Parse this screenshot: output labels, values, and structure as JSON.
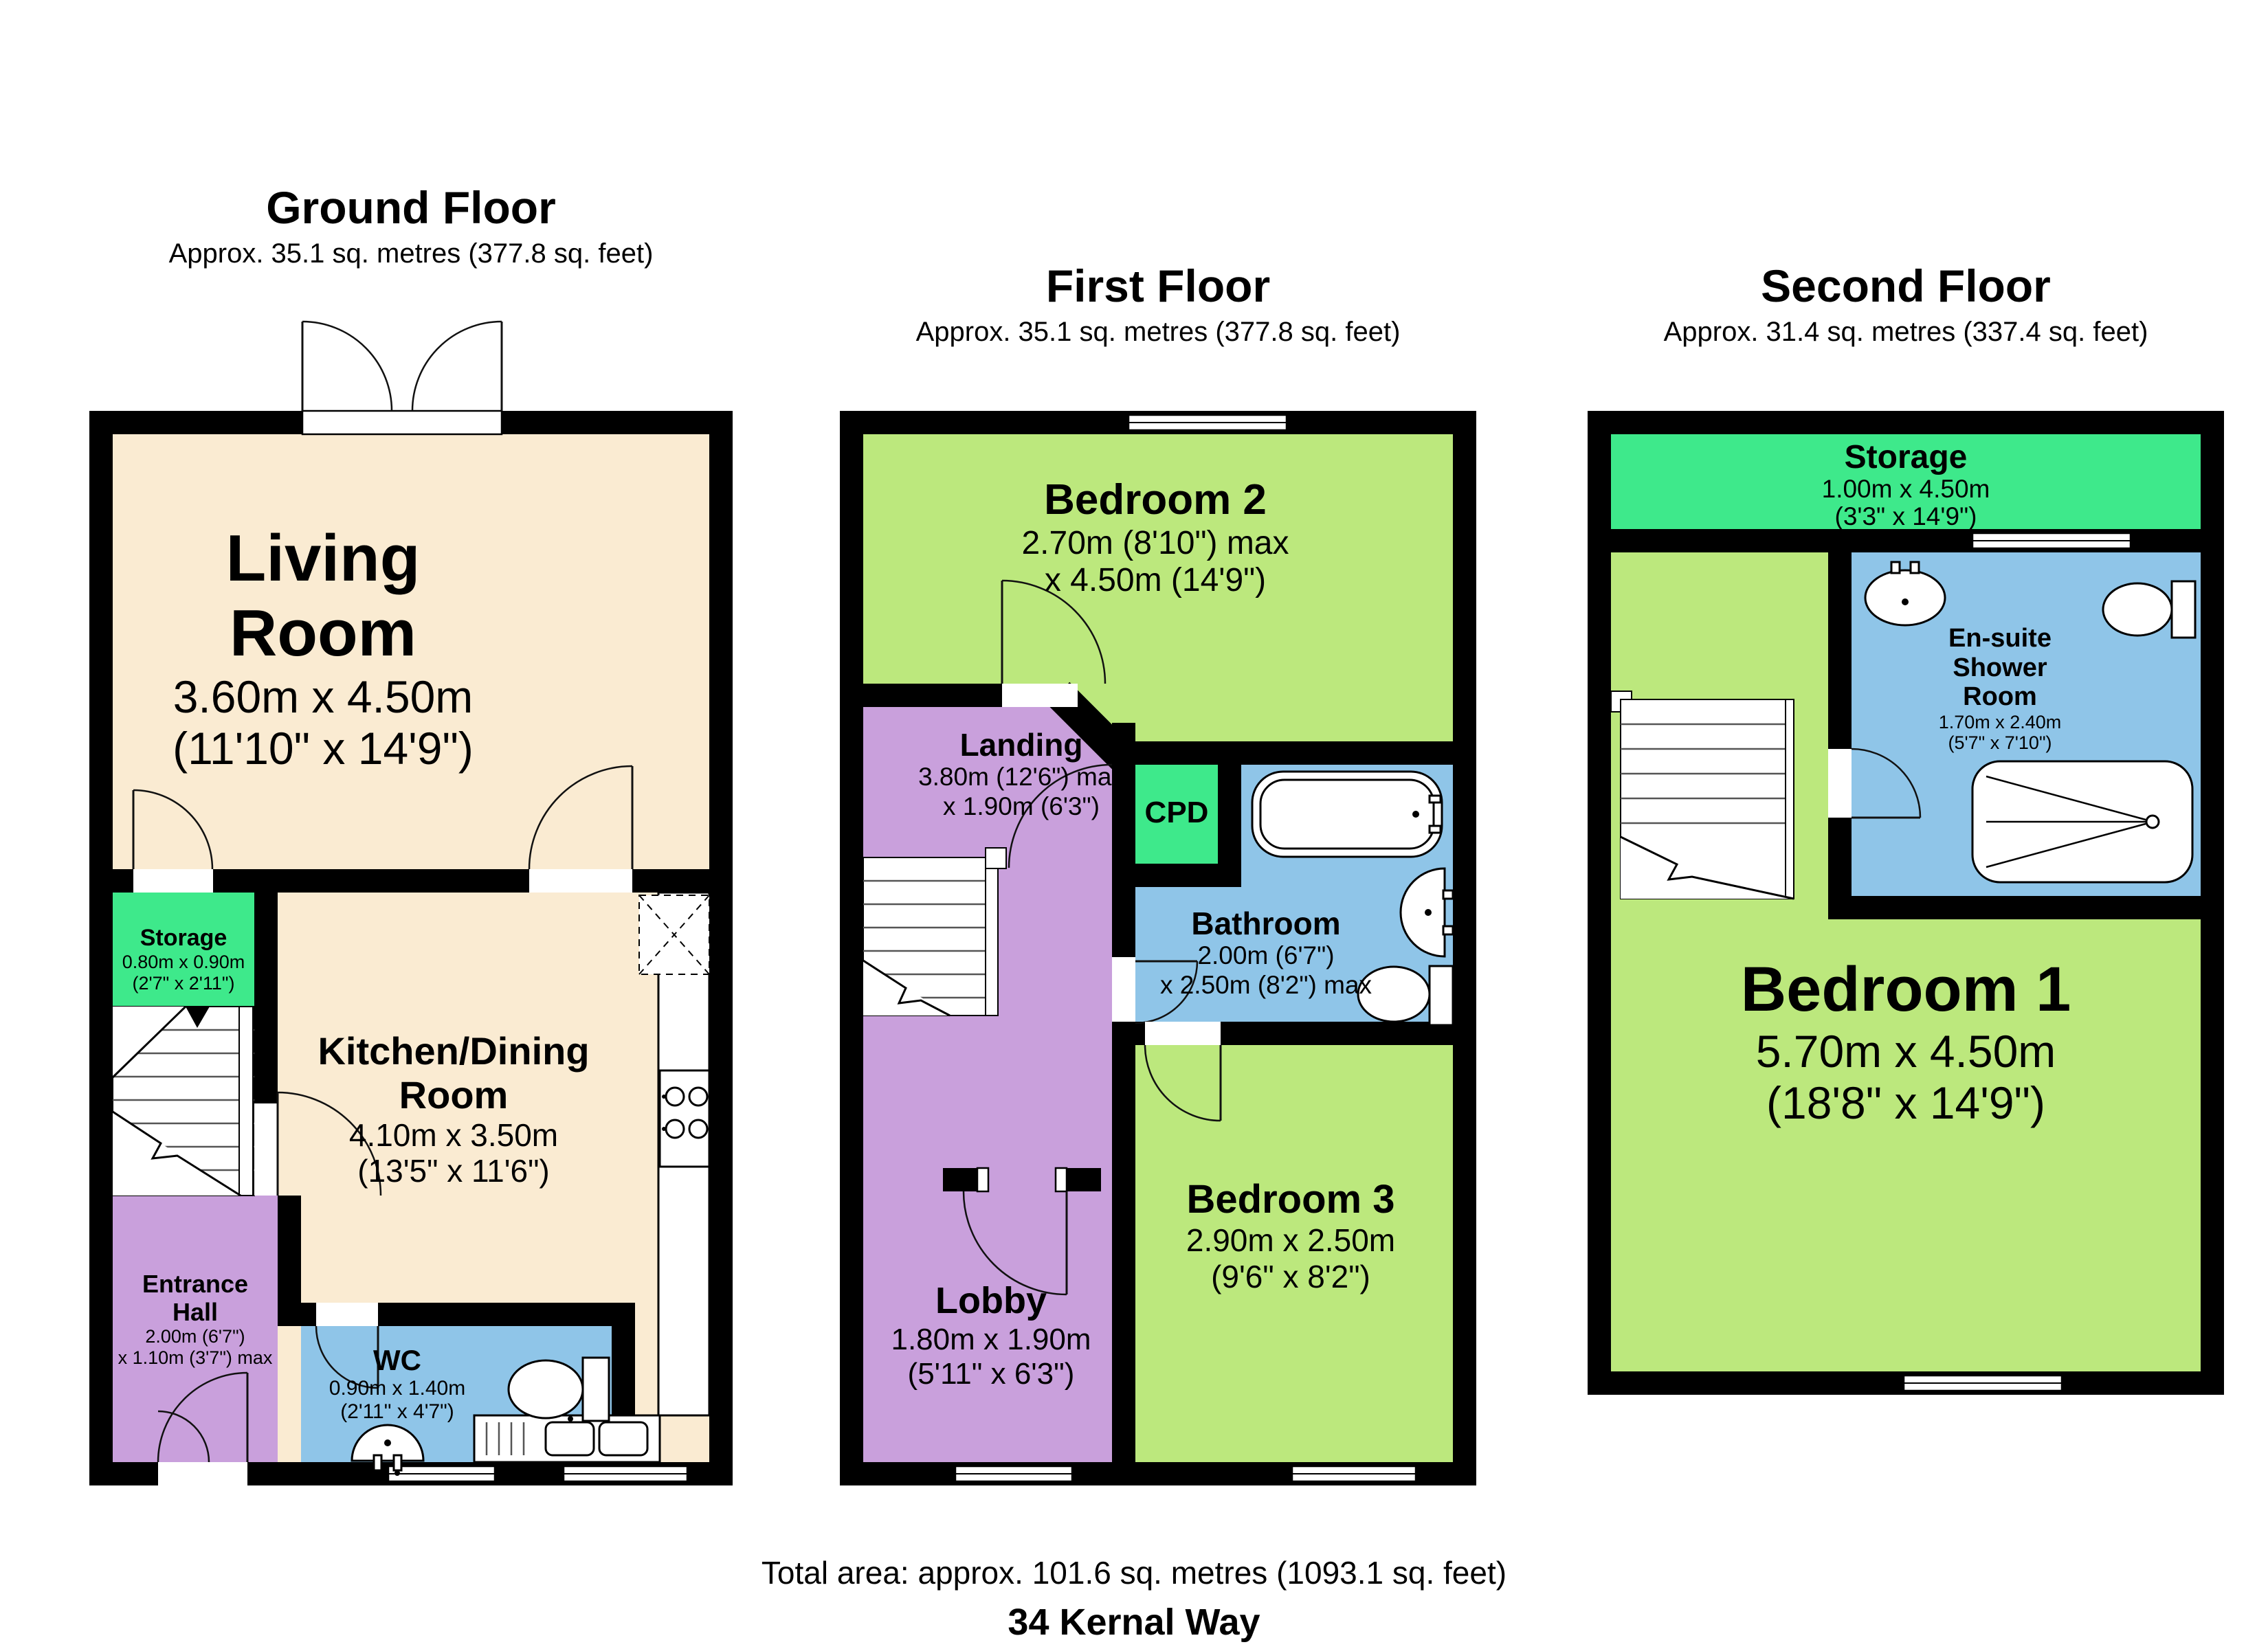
{
  "document": {
    "total_area": "Total area: approx. 101.6 sq. metres (1093.1 sq. feet)",
    "address": "34 Kernal Way"
  },
  "colors": {
    "cream": "#FAEBD2",
    "room_green": "#BCE87D",
    "bright_green": "#3EE98B",
    "purple": "#C9A0DC",
    "blue": "#8FC5E8",
    "wall": "#000000"
  },
  "floors": [
    {
      "name": "Ground Floor",
      "area": "Approx. 35.1 sq. metres (377.8 sq. feet)",
      "rooms": [
        {
          "name": "Living Room",
          "dim1": "3.60m x 4.50m",
          "dim2": "(11'10\" x 14'9\")"
        },
        {
          "name": "Storage",
          "dim1": "0.80m x 0.90m",
          "dim2": "(2'7\" x 2'11\")"
        },
        {
          "name": "Kitchen/Dining Room",
          "dim1": "4.10m x 3.50m",
          "dim2": "(13'5\" x 11'6\")"
        },
        {
          "name": "Entrance Hall",
          "dim1": "2.00m (6'7\")",
          "dim2": "x 1.10m (3'7\") max"
        },
        {
          "name": "WC",
          "dim1": "0.90m x 1.40m",
          "dim2": "(2'11\" x 4'7\")"
        }
      ]
    },
    {
      "name": "First Floor",
      "area": "Approx. 35.1 sq. metres (377.8 sq. feet)",
      "rooms": [
        {
          "name": "Bedroom 2",
          "dim1": "2.70m (8'10\") max",
          "dim2": "x 4.50m (14'9\")"
        },
        {
          "name": "Landing",
          "dim1": "3.80m (12'6\") max",
          "dim2": "x 1.90m (6'3\")"
        },
        {
          "name": "CPD"
        },
        {
          "name": "Bathroom",
          "dim1": "2.00m (6'7\")",
          "dim2": "x 2.50m (8'2\") max"
        },
        {
          "name": "Bedroom 3",
          "dim1": "2.90m x 2.50m",
          "dim2": "(9'6\" x 8'2\")"
        },
        {
          "name": "Lobby",
          "dim1": "1.80m x 1.90m",
          "dim2": "(5'11\" x 6'3\")"
        }
      ]
    },
    {
      "name": "Second Floor",
      "area": "Approx. 31.4 sq. metres (337.4 sq. feet)",
      "rooms": [
        {
          "name": "Storage",
          "dim1": "1.00m x 4.50m",
          "dim2": "(3'3\" x 14'9\")"
        },
        {
          "name": "En-suite Shower Room",
          "dim1": "1.70m x 2.40m",
          "dim2": "(5'7\" x 7'10\")"
        },
        {
          "name": "Bedroom 1",
          "dim1": "5.70m x 4.50m",
          "dim2": "(18'8\" x 14'9\")"
        }
      ]
    }
  ]
}
